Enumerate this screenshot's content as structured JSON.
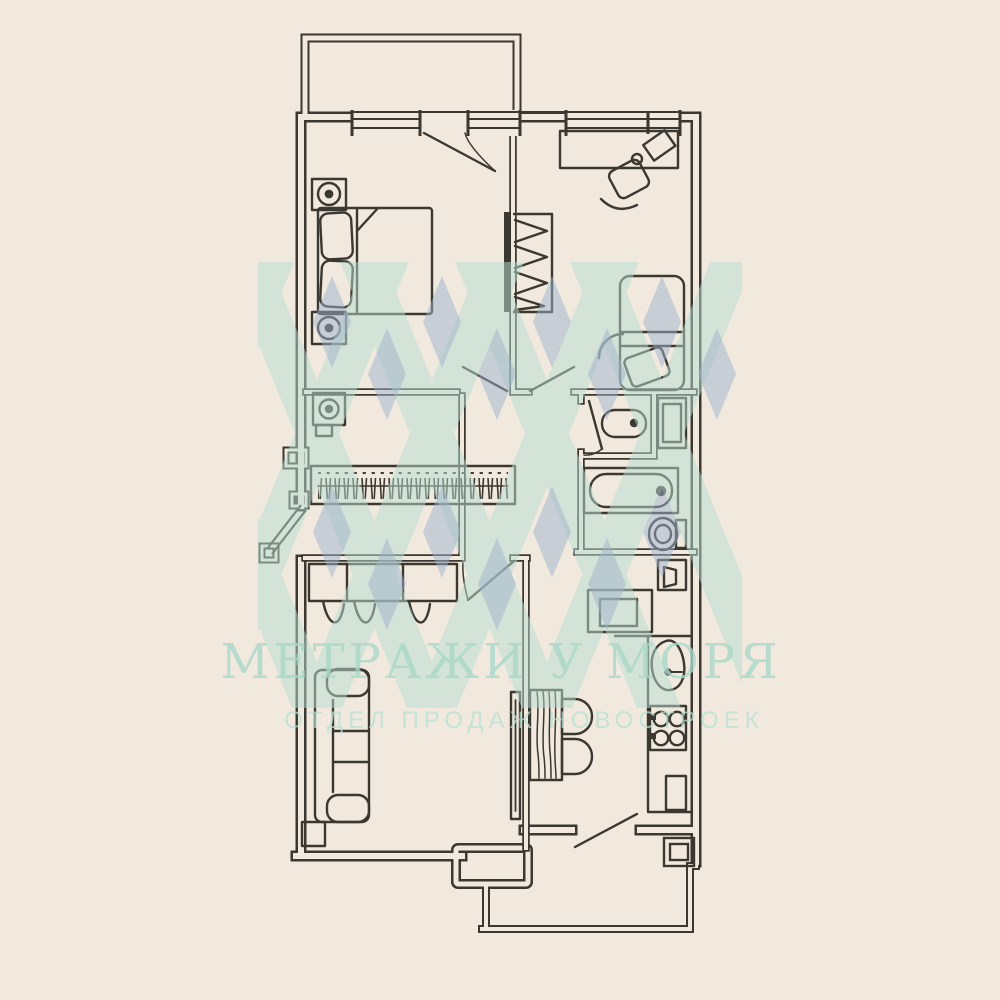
{
  "watermark": {
    "title": "МЕТРАЖИ У МОРЯ",
    "subtitle": "ОТДЕЛ ПРОДАЖ НОВОСТРОЕК"
  },
  "palette": {
    "background": "#f1e9de",
    "line": "#3b3731",
    "watermark_mint": "#b9ded1",
    "watermark_blue": "#9db3cc",
    "watermark_text": "#a9d8c9"
  },
  "floorplan": {
    "type": "apartment-floor-plan",
    "rooms": [
      "balcony-top",
      "bedroom",
      "children-room",
      "dressing-room",
      "hallway",
      "washroom",
      "bathroom",
      "toilet",
      "living-room",
      "kitchen",
      "balcony-bottom"
    ],
    "fixtures": [
      "double-bed",
      "pillows",
      "nightstand-lamp",
      "nightstand-lamp",
      "wardrobe-hanger-rail",
      "desk",
      "office-chair",
      "single-bed",
      "washing-machine",
      "clothes-rail-closet",
      "wash-basin",
      "vent-shaft",
      "bathtub",
      "toilet-bowl",
      "shelf-unit",
      "dresser-cabinet",
      "sofa",
      "side-table",
      "tv-panel",
      "dining-table",
      "chair",
      "chair",
      "kitchen-sink",
      "stove-4-burner",
      "kitchen-counter",
      "entry-closet"
    ]
  }
}
